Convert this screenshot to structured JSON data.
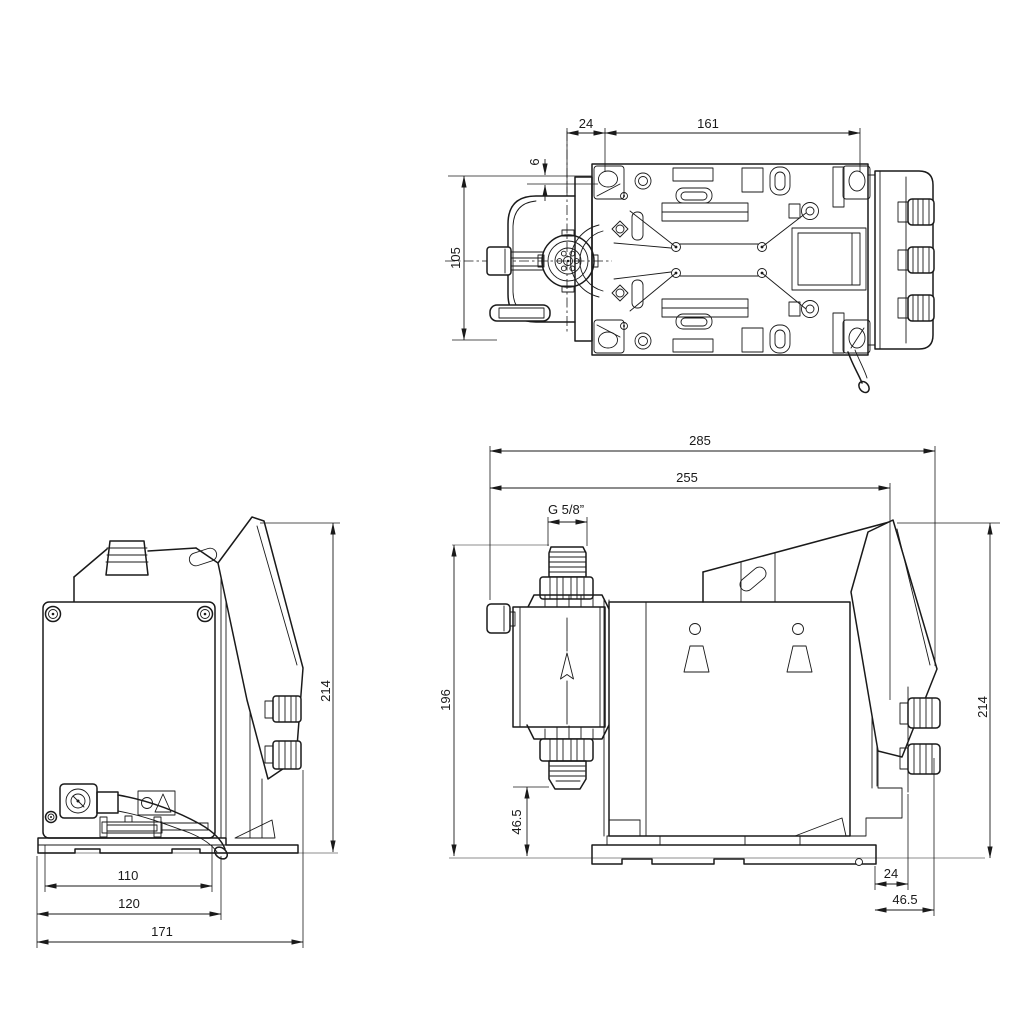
{
  "drawing": {
    "description": "dosing pump dimensional drawing, three orthographic views",
    "colors": {
      "line": "#1a1a1a",
      "ground_line": "#b3b3b3",
      "background": "#ffffff"
    },
    "dims": {
      "top_view": {
        "hole_offset_x": "24",
        "hole_spacing": "161",
        "hole_offset_y": "6",
        "mounting_depth": "105"
      },
      "side_view": {
        "overall_length": "285",
        "length_to_valve": "255",
        "connection_thread": "G 5/8”",
        "height_to_connection": "196",
        "valve_clearance": "46.5",
        "knob_offset": "24",
        "panel_offset": "46.5",
        "overall_height": "214"
      },
      "rear_view": {
        "overall_height": "214",
        "enclosure_width": "110",
        "base_width": "120",
        "overall_width": "171"
      }
    }
  }
}
